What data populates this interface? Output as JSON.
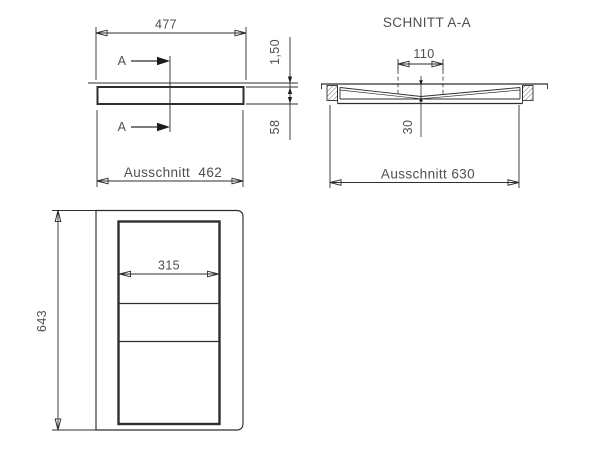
{
  "drawing_type": "technical-drawing",
  "side_view": {
    "width_dim": "477",
    "rim_height_dim": "1,50",
    "depth_dim": "58",
    "cutout_label": "Ausschnitt  462",
    "section_label_top": "A",
    "section_label_bottom": "A"
  },
  "section_view": {
    "title": "SCHNITT A-A",
    "drain_width_dim": "110",
    "depth_dim": "30",
    "cutout_label": "Ausschnitt 630"
  },
  "plan_view": {
    "inner_width_dim": "315",
    "length_dim": "643"
  },
  "colors": {
    "background": "#ffffff",
    "line": "#2e2e2e",
    "text": "#4f4f4f"
  }
}
